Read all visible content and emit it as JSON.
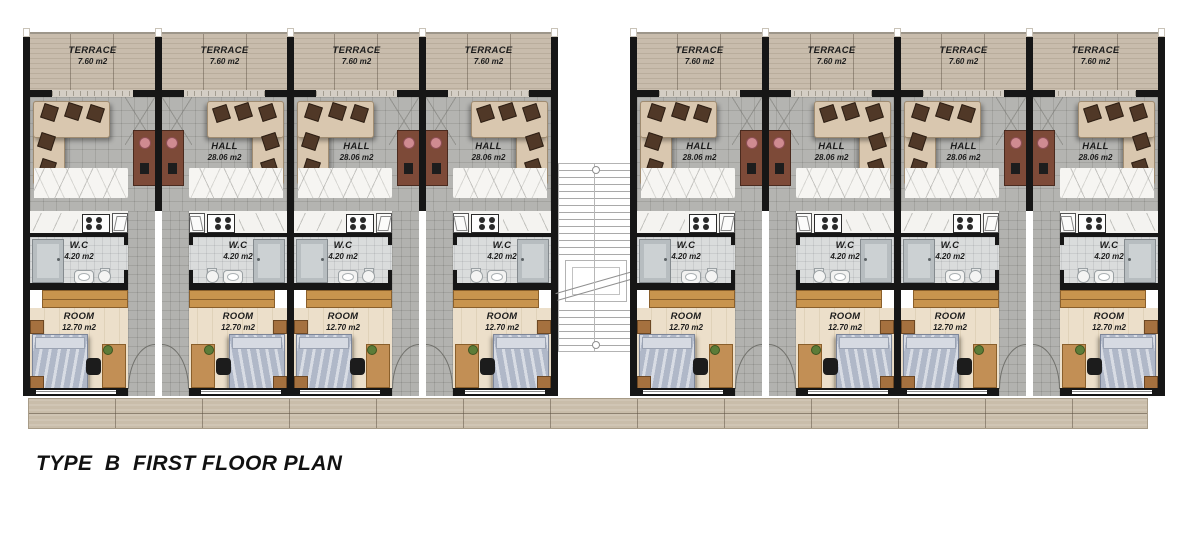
{
  "title": "TYPE  B  FIRST FLOOR PLAN",
  "plan": {
    "type": "residential-floor-plan",
    "rooms": {
      "terrace": {
        "name": "TERRACE",
        "area": "7.60 m2"
      },
      "hall": {
        "name": "HALL",
        "area": "28.06 m2"
      },
      "wc": {
        "name": "W.C",
        "area": "4.20 m2"
      },
      "room": {
        "name": "ROOM",
        "area": "12.70 m2"
      }
    },
    "units": [
      {
        "id": 1,
        "block": "left",
        "mirrored": false,
        "labels": {
          "terrace": true,
          "hall": false,
          "wc": true,
          "room": true
        }
      },
      {
        "id": 2,
        "block": "left",
        "mirrored": true,
        "labels": {
          "terrace": true,
          "hall": true,
          "wc": true,
          "room": true
        }
      },
      {
        "id": 3,
        "block": "left",
        "mirrored": false,
        "labels": {
          "terrace": true,
          "hall": true,
          "wc": true,
          "room": true
        }
      },
      {
        "id": 4,
        "block": "left",
        "mirrored": true,
        "labels": {
          "terrace": true,
          "hall": true,
          "wc": true,
          "room": true
        }
      },
      {
        "id": 5,
        "block": "right",
        "mirrored": false,
        "labels": {
          "terrace": true,
          "hall": true,
          "wc": true,
          "room": true
        }
      },
      {
        "id": 6,
        "block": "right",
        "mirrored": true,
        "labels": {
          "terrace": true,
          "hall": true,
          "wc": true,
          "room": true
        }
      },
      {
        "id": 7,
        "block": "right",
        "mirrored": false,
        "labels": {
          "terrace": true,
          "hall": true,
          "wc": true,
          "room": true
        }
      },
      {
        "id": 8,
        "block": "right",
        "mirrored": true,
        "labels": {
          "terrace": true,
          "hall": true,
          "wc": true,
          "room": true
        }
      }
    ],
    "colors": {
      "wall": "#161616",
      "terrace_wood": "#c0b4a4",
      "hall_tile": "#b4b4b1",
      "wc_tile": "#dadcdc",
      "room_floor": "#ecdfca",
      "walkway_wood": "#c9bdaa",
      "sofa": "#d9c7af",
      "sofa_cushion": "#503827",
      "dining_table": "#7d4a38",
      "chair_pink": "#cf8b91",
      "wardrobe": "#c8944e",
      "bed": "#b0b8c8",
      "desk": "#c28f55",
      "plant": "#5c7c38",
      "title_text": "#111111"
    }
  }
}
